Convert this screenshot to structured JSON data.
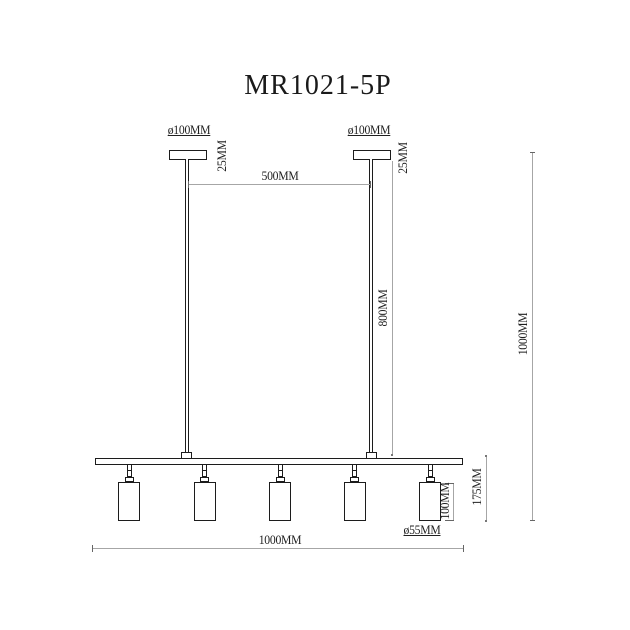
{
  "title": "MR1021-5P",
  "labels": {
    "canopy_left_diameter": "ø100MM",
    "canopy_right_diameter": "ø100MM",
    "canopy_left_thickness": "25MM",
    "canopy_right_thickness": "25MM",
    "rod_spacing": "500MM",
    "rod_drop": "800MM",
    "overall_height": "1000MM",
    "bar_length": "1000MM",
    "spot_body_height": "100MM",
    "spot_total_drop": "175MM",
    "spot_diameter": "ø55MM"
  },
  "structure": {
    "spot_count": 5
  },
  "colors": {
    "background": "#ffffff",
    "outline": "#1c1c1c",
    "dimension_line": "#a6a6a6",
    "text": "#1f1f1f"
  }
}
